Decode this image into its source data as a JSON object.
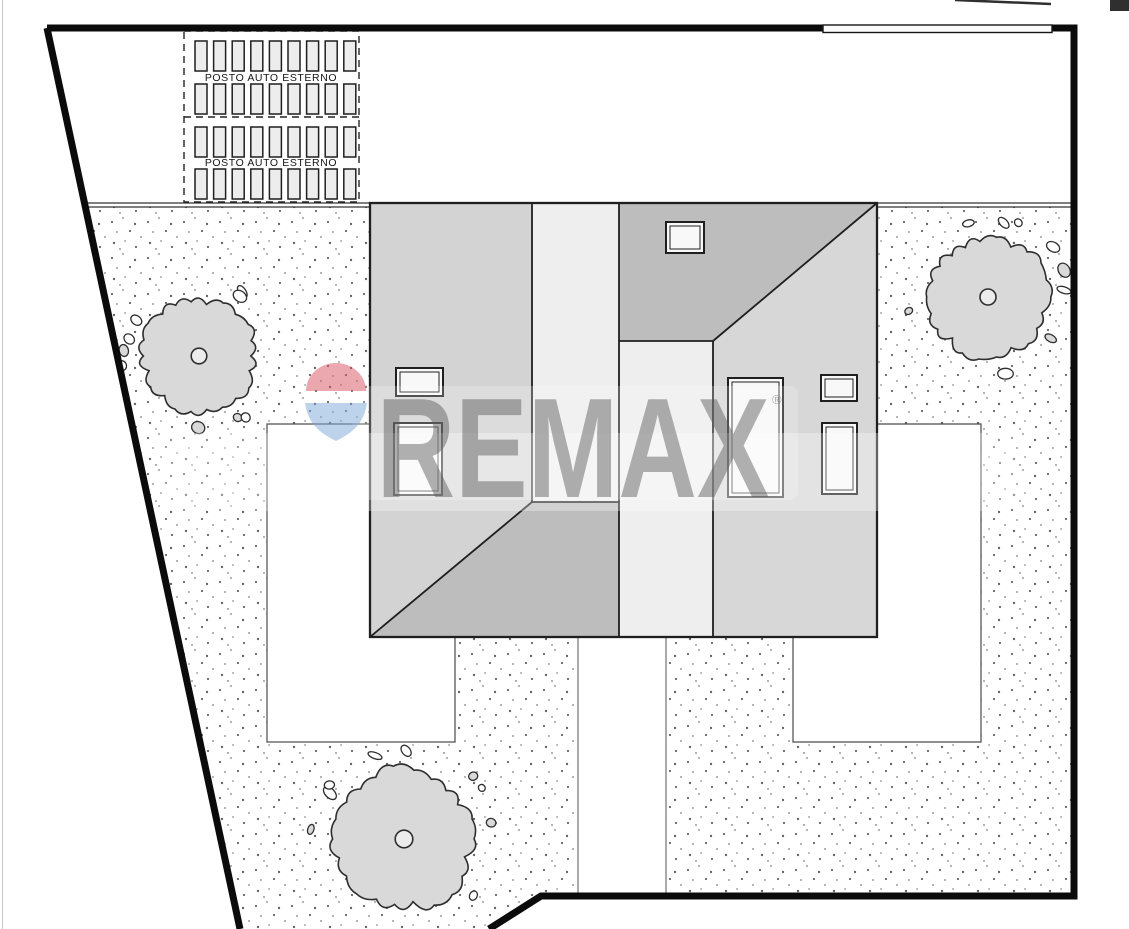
{
  "parking": {
    "label": "POSTO AUTO ESTERNO",
    "blocks": 2,
    "rows_per_block": 2,
    "stalls_per_row": 9,
    "geometry": {
      "x0": 195,
      "pitch": 18.6,
      "stall_w": 12,
      "stall_h": 30,
      "rows_y": [
        41,
        84,
        127,
        169
      ]
    }
  },
  "watermark": {
    "brand": "REMAX",
    "registered": "®"
  },
  "trees": [
    {
      "cx": 199,
      "cy": 356,
      "r": 60,
      "seed": 11
    },
    {
      "cx": 988,
      "cy": 297,
      "r": 63,
      "seed": 23
    },
    {
      "cx": 404,
      "cy": 839,
      "r": 73,
      "seed": 37
    }
  ],
  "colors": {
    "boundary": "#0b0b0b",
    "outline": "#1f1f1f",
    "roof_left": "#d3d3d3",
    "roof_dark": "#bdbdbd",
    "roof_light": "#eeeeee",
    "roof_right": "#d7d7d7",
    "skylight": "#f8f8f8",
    "stipple_dot": "#4a4a4a",
    "tree_fill": "#d9d9d9",
    "tree_stroke": "#2e2e2e",
    "wm_text": "#5b5b5b",
    "balloon_red": "#d9525f",
    "balloon_blue": "#7ea6d8"
  }
}
